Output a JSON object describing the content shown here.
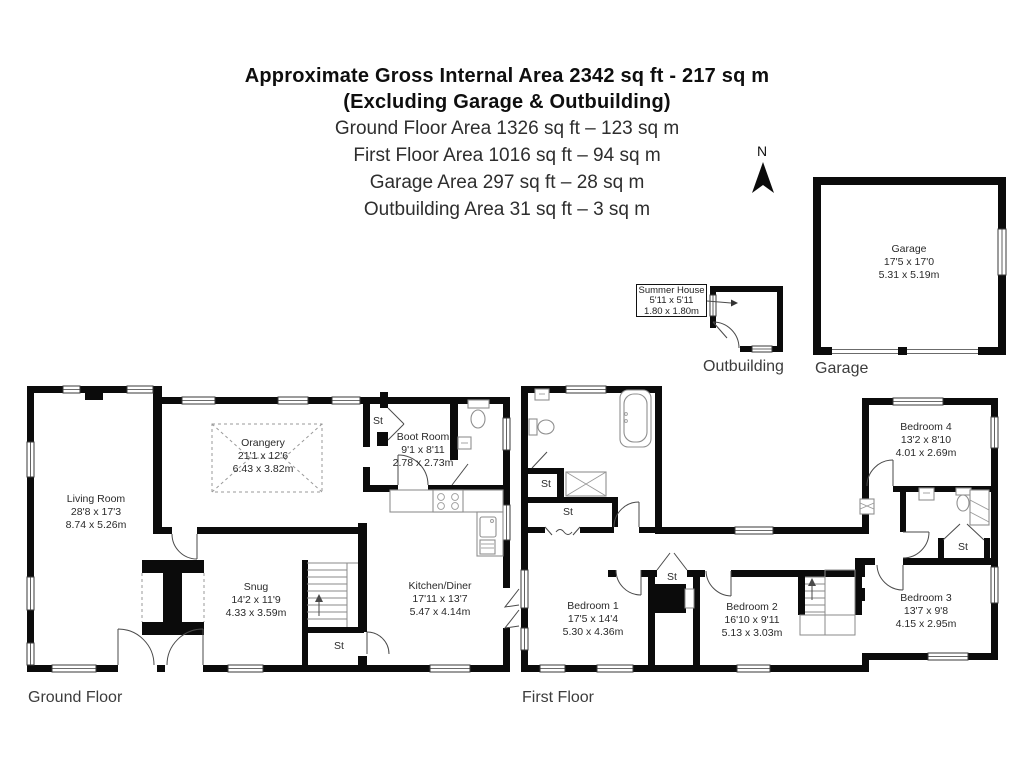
{
  "header": {
    "title": "Approximate Gross Internal Area 2342 sq ft - 217 sq m",
    "subtitle": "(Excluding Garage & Outbuilding)",
    "areas": [
      "Ground Floor Area 1326 sq ft – 123 sq m",
      "First Floor Area 1016 sq ft – 94 sq m",
      "Garage Area 297 sq ft – 28 sq m",
      "Outbuilding Area 31 sq ft – 3 sq m"
    ]
  },
  "compass": {
    "north_label": "N"
  },
  "labels": {
    "st": "St"
  },
  "captions": {
    "ground_floor": "Ground Floor",
    "first_floor": "First Floor",
    "garage": "Garage",
    "outbuilding": "Outbuilding"
  },
  "rooms": {
    "living_room": {
      "name": "Living Room",
      "imperial": "28'8 x 17'3",
      "metric": "8.74 x 5.26m"
    },
    "orangery": {
      "name": "Orangery",
      "imperial": "21'1 x 12'6",
      "metric": "6.43 x 3.82m"
    },
    "boot_room": {
      "name": "Boot Room",
      "imperial": "9'1 x 8'11",
      "metric": "2.78 x 2.73m"
    },
    "snug": {
      "name": "Snug",
      "imperial": "14'2 x 11'9",
      "metric": "4.33 x 3.59m"
    },
    "kitchen_diner": {
      "name": "Kitchen/Diner",
      "imperial": "17'11 x 13'7",
      "metric": "5.47 x 4.14m"
    },
    "bedroom_1": {
      "name": "Bedroom 1",
      "imperial": "17'5 x 14'4",
      "metric": "5.30 x 4.36m"
    },
    "bedroom_2": {
      "name": "Bedroom 2",
      "imperial": "16'10 x 9'11",
      "metric": "5.13 x 3.03m"
    },
    "bedroom_3": {
      "name": "Bedroom 3",
      "imperial": "13'7 x 9'8",
      "metric": "4.15 x 2.95m"
    },
    "bedroom_4": {
      "name": "Bedroom 4",
      "imperial": "13'2 x 8'10",
      "metric": "4.01 x 2.69m"
    },
    "garage": {
      "name": "Garage",
      "imperial": "17'5 x 17'0",
      "metric": "5.31 x 5.19m"
    },
    "summer_house": {
      "name": "Summer House",
      "imperial": "5'11 x 5'11",
      "metric": "1.80 x 1.80m"
    }
  }
}
